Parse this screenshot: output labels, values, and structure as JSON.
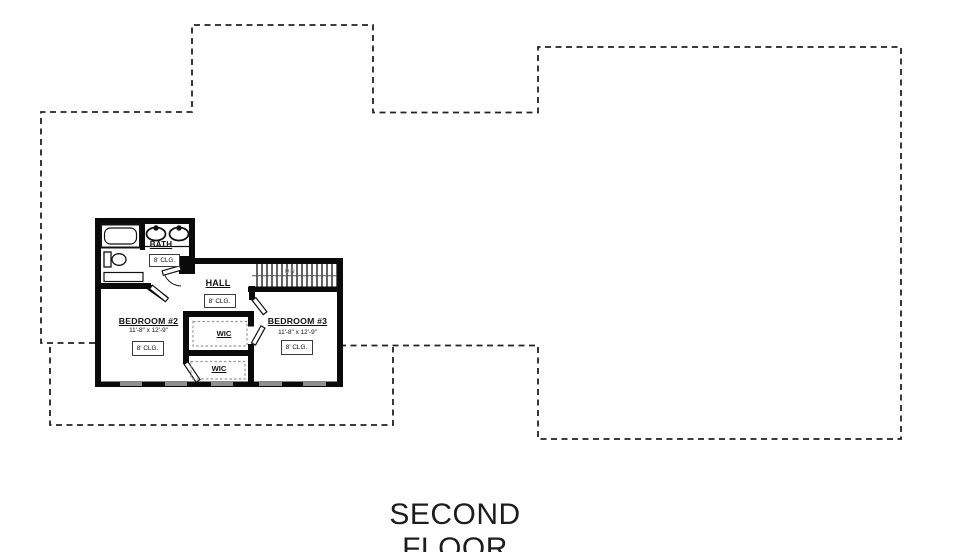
{
  "title": {
    "text": "SECOND FLOOR"
  },
  "stairs": {
    "label": "DN"
  },
  "rooms": {
    "bath": {
      "name": "BATH",
      "ceiling": "8' CLG."
    },
    "hall": {
      "name": "HALL",
      "ceiling": "8' CLG."
    },
    "bedroom2": {
      "name": "BEDROOM #2",
      "dims": "11'-8\" x 12'-9\"",
      "ceiling": "8' CLG."
    },
    "bedroom3": {
      "name": "BEDROOM #3",
      "dims": "11'-8\" x 12'-9\"",
      "ceiling": "8' CLG."
    },
    "wic_upper": {
      "name": "WIC"
    },
    "wic_lower": {
      "name": "WIC"
    }
  },
  "colors": {
    "background": "#ffffff",
    "wall": "#0a0a0a",
    "window": "#8f8f8f",
    "outline_dash": "#222222",
    "shelf_dash": "#999999",
    "text": "#111111"
  }
}
